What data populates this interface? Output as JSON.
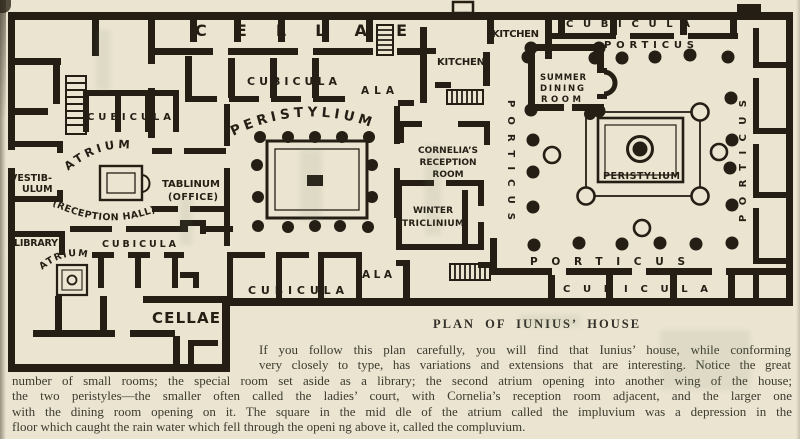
{
  "colors": {
    "paper": "#eae4d0",
    "ink": "#241e15",
    "bodytext": "#3c3b30"
  },
  "plan": {
    "labels": {
      "cellae_top": "CELLAE",
      "cellae_bottom": "CELLAE",
      "cubicula_topleft": "CUBICULA",
      "cubicula_midtop": "CUBICULA",
      "cubicula_topright": "CUBICULA",
      "cubicula_lowerleft": "CUBICULA",
      "cubicula_bottomcenter": "CUBICULA",
      "cubicula_bottomright": "CUBICULA",
      "ala_top": "ALA",
      "ala_bottom": "ALA",
      "peristylium_left": "PERISTYLIUM",
      "peristylium_right": "PERISTYLIUM",
      "atrium_main": "ATRIUM",
      "atrium_small": "ATRIUM",
      "reception_hall": "(RECEPTION HALL)",
      "vestibulum_line1": "VESTIB-",
      "vestibulum_line2": "ULUM",
      "tablinum_line1": "TABLINUM",
      "tablinum_line2": "(OFFICE)",
      "library": "LIBRARY",
      "kitchen_top": "KITCHEN",
      "kitchen_left": "KITCHEN",
      "summer_dining_line1": "SUMMER",
      "summer_dining_line2": "DINING",
      "summer_dining_line3": "ROOM",
      "cornelia_line1": "CORNELIA’S",
      "cornelia_line2": "RECEPTION",
      "cornelia_line3": "ROOM",
      "winter_line1": "WINTER",
      "winter_line2": "TRICLINIUM",
      "porticus_top": "PORTICUS",
      "porticus_bottom": "PORTICUS",
      "porticus_left_vertical": "PORTICUS",
      "porticus_right_vertical": "PORTICUS"
    }
  },
  "caption": "PLAN OF IUNIUS’ HOUSE",
  "paragraph": {
    "lines": [
      "If you follow this plan carefully, you will find that Iunius’ house, while conforming",
      "very closely to type, has variations and extensions that are interesting. Notice the great",
      "number of small rooms; the special room set aside as a library; the second atrium opening into another wing of the house;",
      "the two peristyles—the smaller often called the ladies’ court, with Cornelia’s reception room adjacent, and the larger one",
      "with the dining room opening on it.  The square in the mid dle of the atrium called the impluvium was a depression in the",
      "floor which caught the rain water which fell through the openi ng above it, called the compluvium."
    ]
  }
}
